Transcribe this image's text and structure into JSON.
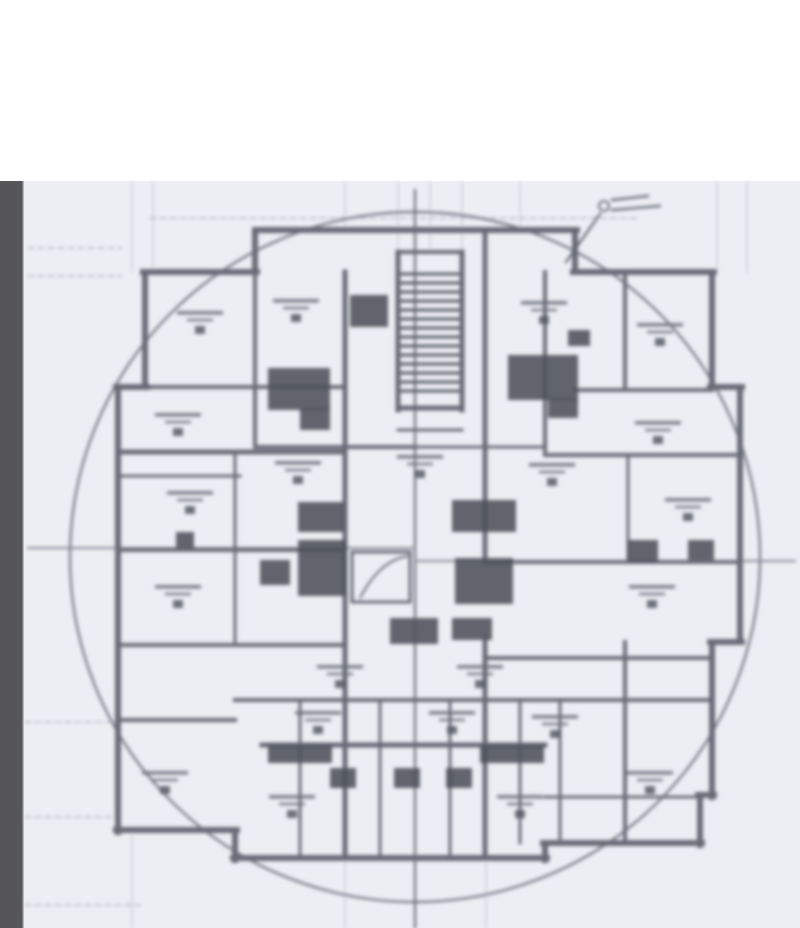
{
  "document": {
    "kind": "scanned architectural floor plan (blurred, no legible text)",
    "legible_text": ""
  },
  "colors": {
    "page_white": "#ffffff",
    "paper": "#edeef4",
    "sidebar": "#565659",
    "sidebar_edge": "#7e7e81",
    "grid_faint": "#c6cad6",
    "grid_dashed": "#b6bac7",
    "circle": "#797d88",
    "centerline": "#60646e",
    "datum": "#83879",
    "wall": "#676b76",
    "wall_light": "#9096a1",
    "fixture_dark": "#4d515b",
    "label_line": "#6a6e78",
    "label_box": "#555963"
  },
  "layout": {
    "width": 800,
    "height": 928,
    "white_band_height": 181,
    "sidebar_width": 23
  },
  "plan": {
    "circle": {
      "cx": 415,
      "cy": 557,
      "r": 345
    },
    "centerline_v": [
      415,
      190,
      415,
      928
    ],
    "datum_h": [
      [
        28,
        548,
        415,
        548
      ],
      [
        415,
        561,
        795,
        561
      ]
    ],
    "grid_v": [
      [
        132,
        183,
        272
      ],
      [
        153,
        183,
        272
      ],
      [
        345,
        183,
        232
      ],
      [
        398,
        183,
        252
      ],
      [
        430,
        183,
        252
      ],
      [
        462,
        183,
        252
      ],
      [
        520,
        183,
        232
      ],
      [
        717,
        183,
        272
      ],
      [
        747,
        183,
        272
      ],
      [
        345,
        858,
        928
      ],
      [
        486,
        858,
        928
      ],
      [
        132,
        832,
        928
      ]
    ],
    "grid_dashed_h": [
      [
        28,
        248,
        122,
        248
      ],
      [
        28,
        276,
        122,
        276
      ],
      [
        25,
        722,
        118,
        722
      ],
      [
        25,
        817,
        118,
        817
      ],
      [
        150,
        218,
        640,
        218
      ],
      [
        25,
        905,
        140,
        905
      ]
    ],
    "walls": [
      [
        255,
        230,
        577,
        230,
        6
      ],
      [
        255,
        230,
        255,
        272,
        6
      ],
      [
        575,
        230,
        575,
        272,
        6
      ],
      [
        143,
        272,
        257,
        272,
        6
      ],
      [
        573,
        272,
        714,
        272,
        6
      ],
      [
        145,
        272,
        145,
        387,
        6
      ],
      [
        712,
        272,
        712,
        387,
        6
      ],
      [
        116,
        387,
        147,
        387,
        6
      ],
      [
        710,
        387,
        742,
        387,
        6
      ],
      [
        118,
        387,
        118,
        832,
        6
      ],
      [
        740,
        387,
        740,
        642,
        6
      ],
      [
        710,
        642,
        742,
        642,
        6
      ],
      [
        712,
        642,
        712,
        797,
        6
      ],
      [
        116,
        830,
        237,
        830,
        6
      ],
      [
        235,
        830,
        235,
        860,
        6
      ],
      [
        233,
        858,
        547,
        858,
        6
      ],
      [
        545,
        845,
        545,
        860,
        6
      ],
      [
        543,
        843,
        702,
        843,
        6
      ],
      [
        700,
        795,
        700,
        845,
        6
      ],
      [
        698,
        795,
        714,
        795,
        6
      ],
      [
        255,
        272,
        255,
        447,
        4
      ],
      [
        345,
        272,
        345,
        858,
        5
      ],
      [
        485,
        230,
        485,
        560,
        5
      ],
      [
        485,
        640,
        485,
        858,
        5
      ],
      [
        545,
        272,
        545,
        455,
        4
      ],
      [
        625,
        272,
        625,
        390,
        4
      ],
      [
        625,
        642,
        625,
        843,
        4
      ],
      [
        398,
        252,
        398,
        410,
        5
      ],
      [
        462,
        252,
        462,
        410,
        5
      ],
      [
        398,
        252,
        462,
        252,
        4
      ],
      [
        398,
        408,
        462,
        408,
        5
      ],
      [
        398,
        430,
        462,
        430,
        3
      ],
      [
        300,
        700,
        300,
        858,
        3
      ],
      [
        380,
        700,
        380,
        858,
        3
      ],
      [
        450,
        700,
        450,
        858,
        3
      ],
      [
        520,
        700,
        520,
        843,
        3
      ],
      [
        560,
        700,
        560,
        843,
        3
      ],
      [
        235,
        452,
        235,
        645,
        3
      ],
      [
        628,
        455,
        628,
        562,
        3
      ],
      [
        145,
        387,
        345,
        387,
        4
      ],
      [
        575,
        390,
        712,
        390,
        4
      ],
      [
        118,
        452,
        345,
        452,
        5
      ],
      [
        545,
        455,
        740,
        455,
        4
      ],
      [
        255,
        447,
        415,
        447,
        4
      ],
      [
        415,
        447,
        545,
        447,
        3
      ],
      [
        118,
        550,
        345,
        550,
        4
      ],
      [
        485,
        562,
        740,
        562,
        4
      ],
      [
        118,
        645,
        345,
        645,
        4
      ],
      [
        485,
        658,
        712,
        658,
        4
      ],
      [
        235,
        700,
        712,
        700,
        4
      ],
      [
        262,
        745,
        545,
        745,
        5
      ],
      [
        118,
        720,
        235,
        720,
        4
      ],
      [
        545,
        797,
        700,
        797,
        3
      ],
      [
        118,
        476,
        240,
        476,
        3
      ],
      [
        352,
        552,
        410,
        552,
        3
      ],
      [
        352,
        552,
        352,
        602,
        3
      ],
      [
        410,
        552,
        410,
        602,
        3
      ],
      [
        352,
        602,
        410,
        602,
        3
      ]
    ],
    "stair_hatch": {
      "x": 402,
      "y": 274,
      "w": 56,
      "h": 124,
      "step": 9
    },
    "elevator_arc": "M360,598 Q380,560 408,556",
    "fixtures": [
      [
        268,
        368,
        62,
        42
      ],
      [
        300,
        408,
        30,
        22
      ],
      [
        350,
        295,
        38,
        32
      ],
      [
        508,
        355,
        70,
        45
      ],
      [
        548,
        398,
        30,
        20
      ],
      [
        298,
        502,
        46,
        30
      ],
      [
        298,
        540,
        48,
        56
      ],
      [
        260,
        560,
        30,
        25
      ],
      [
        452,
        500,
        64,
        32
      ],
      [
        455,
        558,
        58,
        46
      ],
      [
        390,
        618,
        48,
        26
      ],
      [
        452,
        618,
        40,
        22
      ],
      [
        268,
        745,
        64,
        18
      ],
      [
        480,
        745,
        64,
        18
      ],
      [
        330,
        768,
        26,
        20
      ],
      [
        394,
        768,
        26,
        20
      ],
      [
        446,
        768,
        26,
        20
      ],
      [
        628,
        540,
        30,
        22
      ],
      [
        688,
        540,
        26,
        20
      ],
      [
        176,
        532,
        18,
        16
      ],
      [
        568,
        330,
        22,
        16
      ]
    ],
    "labels": [
      [
        200,
        318
      ],
      [
        296,
        306
      ],
      [
        544,
        308
      ],
      [
        660,
        330
      ],
      [
        178,
        420
      ],
      [
        658,
        428
      ],
      [
        190,
        498
      ],
      [
        688,
        505
      ],
      [
        178,
        592
      ],
      [
        652,
        592
      ],
      [
        298,
        468
      ],
      [
        552,
        470
      ],
      [
        420,
        462
      ],
      [
        318,
        718
      ],
      [
        452,
        718
      ],
      [
        555,
        722
      ],
      [
        165,
        778
      ],
      [
        292,
        802
      ],
      [
        520,
        802
      ],
      [
        650,
        778
      ],
      [
        340,
        672
      ],
      [
        480,
        672
      ]
    ],
    "annotation_leader": {
      "strokes": [
        [
          612,
          200,
          648,
          196
        ],
        [
          612,
          210,
          660,
          206
        ],
        [
          600,
          214,
          566,
          262
        ]
      ],
      "scribble": {
        "cx": 604,
        "cy": 206,
        "r": 5
      }
    }
  }
}
